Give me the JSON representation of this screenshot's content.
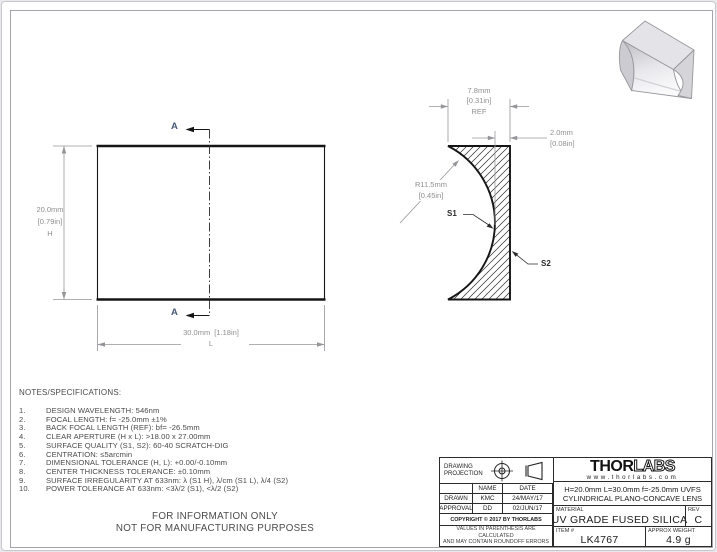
{
  "notes": {
    "header": "NOTES/SPECIFICATIONS:",
    "items": [
      {
        "num": "1.",
        "text": "DESIGN WAVELENGTH: 546nm"
      },
      {
        "num": "2.",
        "text": "FOCAL LENGTH: f= -25.0mm ±1%"
      },
      {
        "num": "3.",
        "text": "BACK FOCAL LENGTH (REF): bf= -26.5mm"
      },
      {
        "num": "4.",
        "text": "CLEAR APERTURE (H x L): >18.00 x 27.00mm"
      },
      {
        "num": "5.",
        "text": "SURFACE QUALITY (S1, S2): 60-40 SCRATCH-DIG"
      },
      {
        "num": "6.",
        "text": "CENTRATION: ≤5arcmin"
      },
      {
        "num": "7.",
        "text": "DIMENSIONAL TOLERANCE (H, L): +0.00/-0.10mm"
      },
      {
        "num": "8.",
        "text": "CENTER THICKNESS TOLERANCE: ±0.10mm"
      },
      {
        "num": "9.",
        "text": "SURFACE IRREGULARITY AT 633nm: λ (S1 H), λ/cm (S1 L), λ/4 (S2)"
      },
      {
        "num": "10.",
        "text": "POWER TOLERANCE AT 633nm: <3λ/2 (S1), <λ/2 (S2)"
      }
    ]
  },
  "info_only": {
    "line1": "FOR INFORMATION ONLY",
    "line2": "NOT FOR MANUFACTURING PURPOSES"
  },
  "front_view": {
    "section_label_top": "A",
    "section_label_bottom": "A",
    "height_dim": {
      "mm": "20.0mm",
      "inch": "[0.79in]",
      "axis": "H"
    },
    "length_dim": {
      "mm": "30.0mm",
      "inch": "[1.18in]",
      "axis": "L"
    }
  },
  "section_view": {
    "thickness_dim": {
      "mm": "7.8mm",
      "inch": "[0.31in]",
      "ref": "REF"
    },
    "center_thickness_dim": {
      "mm": "2.0mm",
      "inch": "[0.08in]"
    },
    "radius_dim": {
      "mm": "R11.5mm",
      "inch": "[0.45in]"
    },
    "s1_label": "S1",
    "s2_label": "S2"
  },
  "title_block": {
    "projection_label": "DRAWING PROJECTION",
    "name_header": "NAME",
    "date_header": "DATE",
    "drawn_label": "DRAWN",
    "drawn_name": "KMC",
    "drawn_date": "24/MAY/17",
    "approval_label": "APPROVAL",
    "approval_name": "DD",
    "approval_date": "02/JUN/17",
    "copyright": "COPYRIGHT © 2017 BY THORLABS",
    "disclaimer1": "VALUES IN PARENTHESIS ARE CALCULATED",
    "disclaimer2": "AND MAY CONTAIN ROUNDOFF ERRORS",
    "logo_part1": "THOR",
    "logo_part2": "LABS",
    "logo_url": "www.thorlabs.com",
    "description_line1": "H=20.0mm L=30.0mm f=-25.0mm UVFS",
    "description_line2": "CYLINDRICAL PLANO-CONCAVE LENS",
    "material_label": "MATERIAL",
    "material": "UV GRADE FUSED SILICA",
    "rev_label": "REV",
    "rev": "C",
    "item_label": "ITEM #",
    "item": "LK4767",
    "weight_label": "APPROX WEIGHT",
    "weight": "4.9 g"
  },
  "colors": {
    "outline": "#151515",
    "dimension": "#8f8f93",
    "section_label": "#4a5878",
    "sheet": "#ffffff"
  }
}
